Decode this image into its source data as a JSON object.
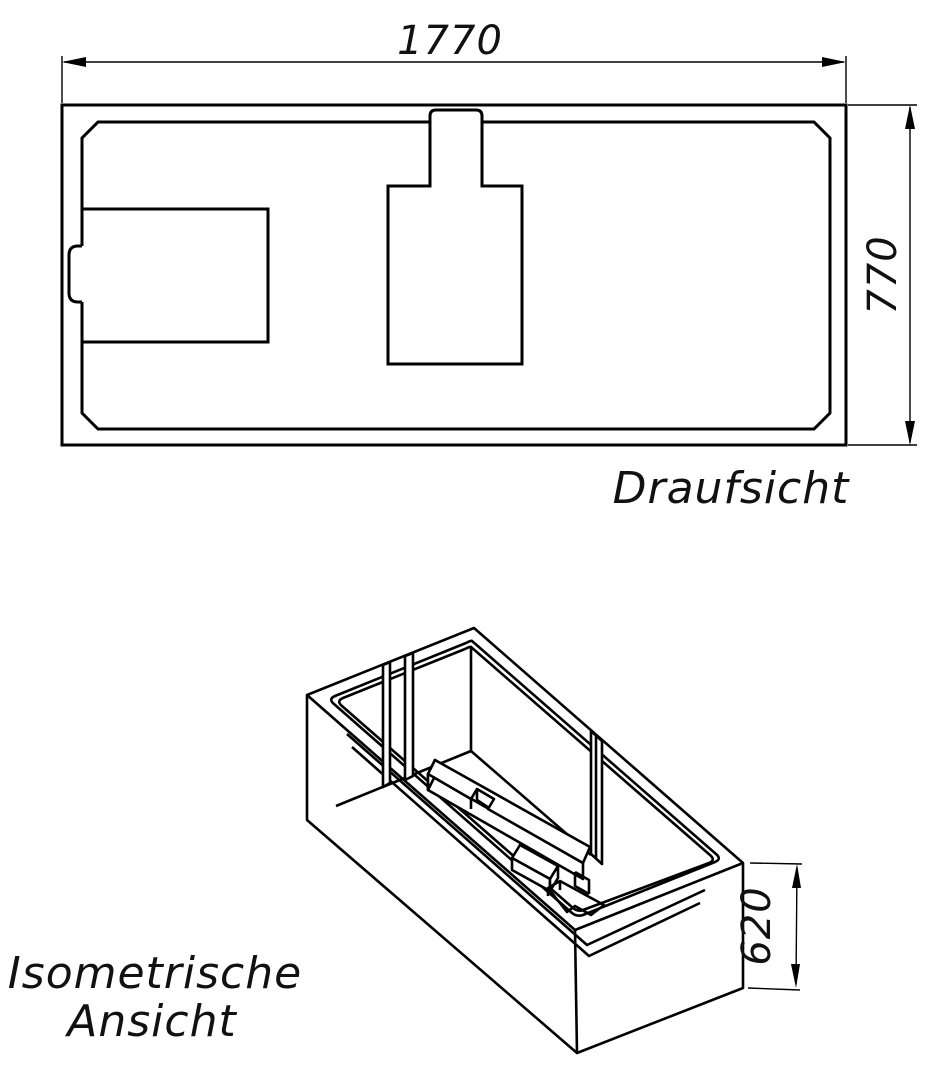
{
  "drawing": {
    "background_color": "#ffffff",
    "line_color": "#000000",
    "views": {
      "top": {
        "name": "Draufsicht",
        "dim_width": "1770",
        "dim_depth": "770"
      },
      "iso": {
        "name_line1": "Isometrische",
        "name_line2": "Ansicht",
        "dim_height": "620"
      }
    }
  }
}
